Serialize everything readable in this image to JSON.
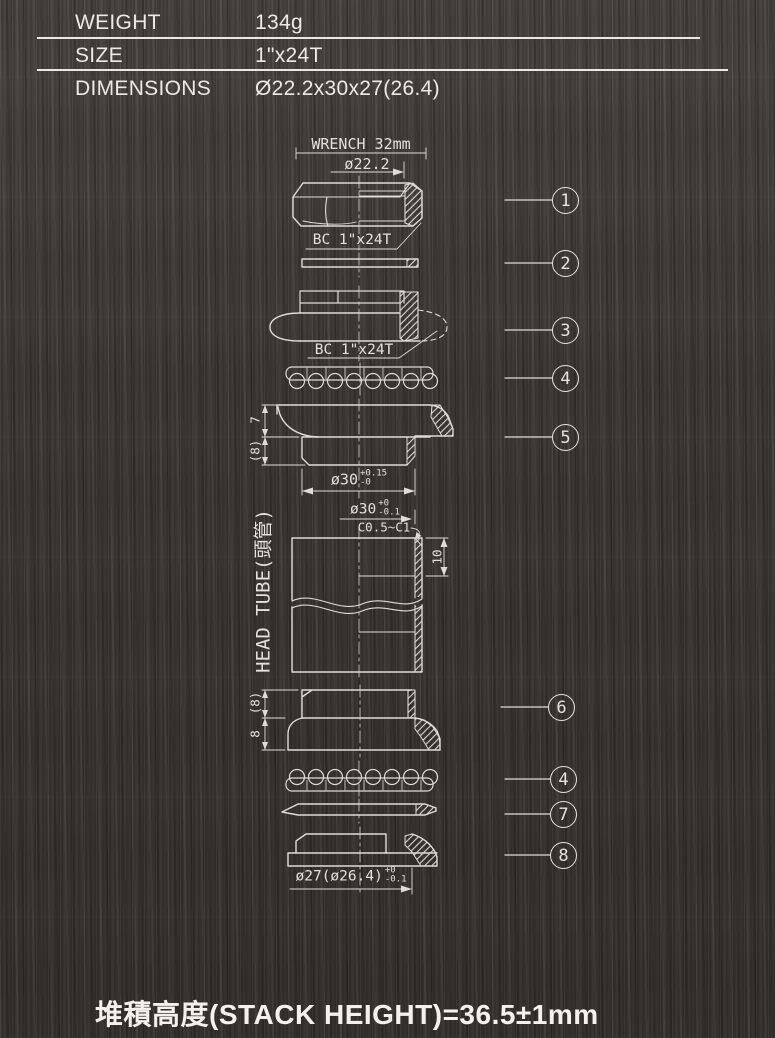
{
  "colors": {
    "background": "#3a3633",
    "linework": "#dedcd8",
    "text": "#ece9e6"
  },
  "spec_table": {
    "rows": [
      {
        "label": "WEIGHT",
        "value": "134g"
      },
      {
        "label": "SIZE",
        "value": "1\"x24T"
      },
      {
        "label": "DIMENSIONS",
        "value": "Ø22.2x30x27(26.4)"
      }
    ]
  },
  "drawing": {
    "annotations": {
      "wrench": "WRENCH 32mm",
      "dia22_2": "ø22.2",
      "bc_thread_locknut": "BC 1\"x24T",
      "bc_thread_race": "BC 1\"x24T",
      "cup_height_upper": "7",
      "cup_height_upper_ref": "(8)",
      "cup_press_dia": {
        "base": "ø30",
        "tol_top": "+0.15",
        "tol_bot": "-0"
      },
      "tube_bore_dia": {
        "base": "ø30",
        "tol_top": "+0",
        "tol_bot": "-0.1"
      },
      "chamfer": "C0.5~C1",
      "bore_depth": "10",
      "head_tube": "HEAD TUBE(頭管)",
      "lower_cup_height_ref": "(8)",
      "lower_cup_height": "8",
      "crown_race_dia": {
        "base": "ø27(ø26.4)",
        "tol_top": "+0",
        "tol_bot": "-0.1"
      }
    },
    "callouts": [
      {
        "num": "1"
      },
      {
        "num": "2"
      },
      {
        "num": "3"
      },
      {
        "num": "4"
      },
      {
        "num": "5"
      },
      {
        "num": "6"
      },
      {
        "num": "4"
      },
      {
        "num": "7"
      },
      {
        "num": "8"
      }
    ]
  },
  "footer": {
    "stack_height": "堆積高度(STACK HEIGHT)=36.5±1mm"
  }
}
